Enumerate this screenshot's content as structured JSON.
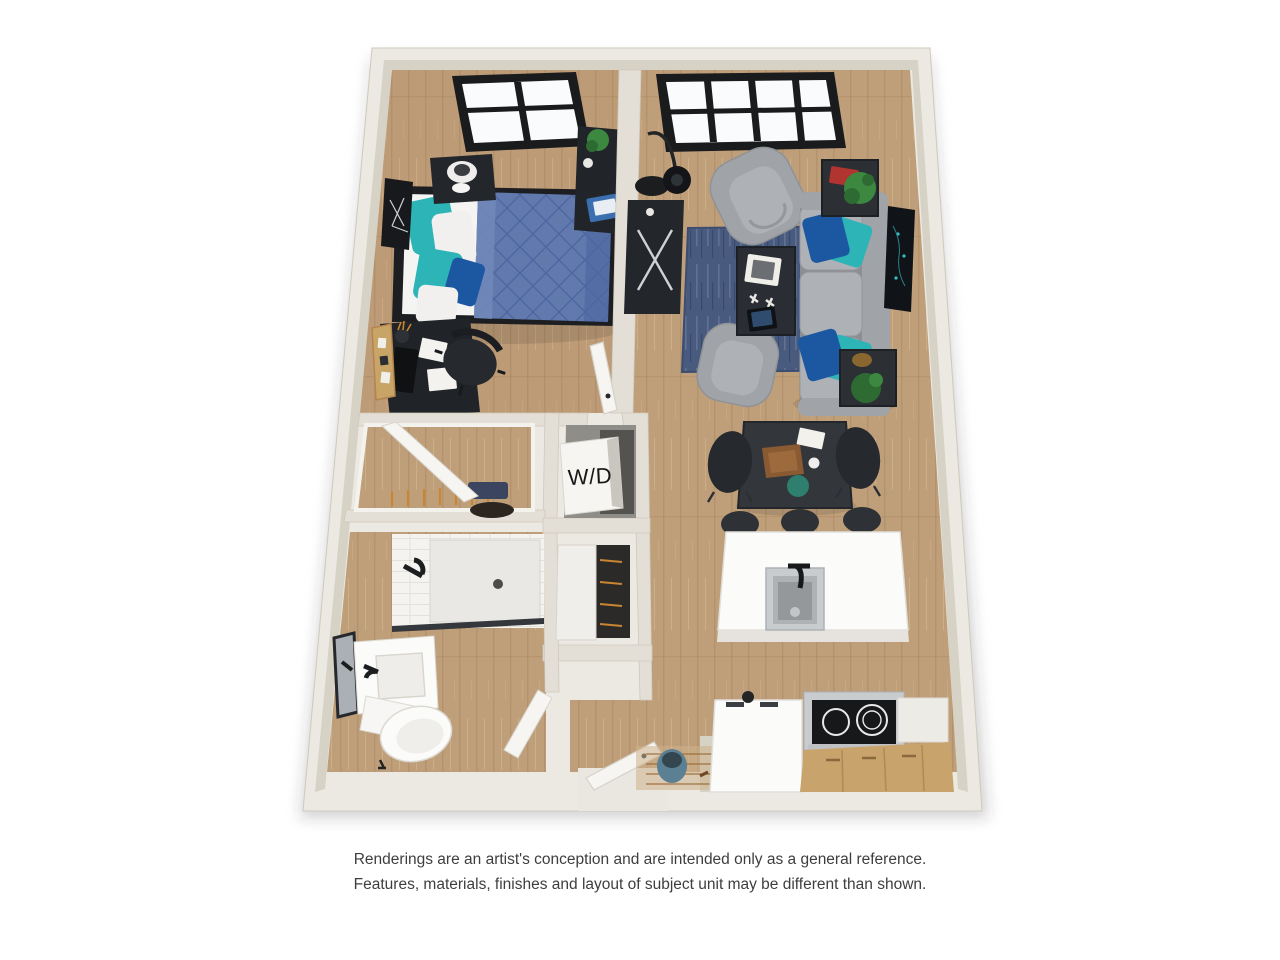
{
  "colors": {
    "wall": "#e3dfd6",
    "wall_light": "#ece9e2",
    "wall_face": "#d7d2c6",
    "floor_wood": "#bf9f7a",
    "floor_wood_dark": "#a8865f",
    "rug": "#485a7d",
    "rug_light": "#65779a",
    "sofa": "#a0a3a7",
    "sofa_dark": "#8b8e92",
    "seat": "#aeb1b5",
    "teal": "#2cb4b7",
    "navy": "#1c58a2",
    "duvet": "#6179ad",
    "duvet_dark": "#4d66a0",
    "dark": "#23262b",
    "dark2": "#32363c",
    "woodcab": "#c9a36c",
    "woodcab_dark": "#b08c55",
    "plant": "#3c8840",
    "plant_dark": "#2e6b33",
    "steel": "#c9ccce",
    "steel_dark": "#9fa3a6",
    "cooktop": "#17181a",
    "mirror": "#aab0b5",
    "text": "#3e3e3e"
  },
  "plan": {
    "wd_label": "W/D"
  },
  "disclaimer": {
    "line1": "Renderings are an artist's conception and are intended only as a general reference.",
    "line2": "Features, materials, finishes and layout of subject unit may be different than shown."
  }
}
